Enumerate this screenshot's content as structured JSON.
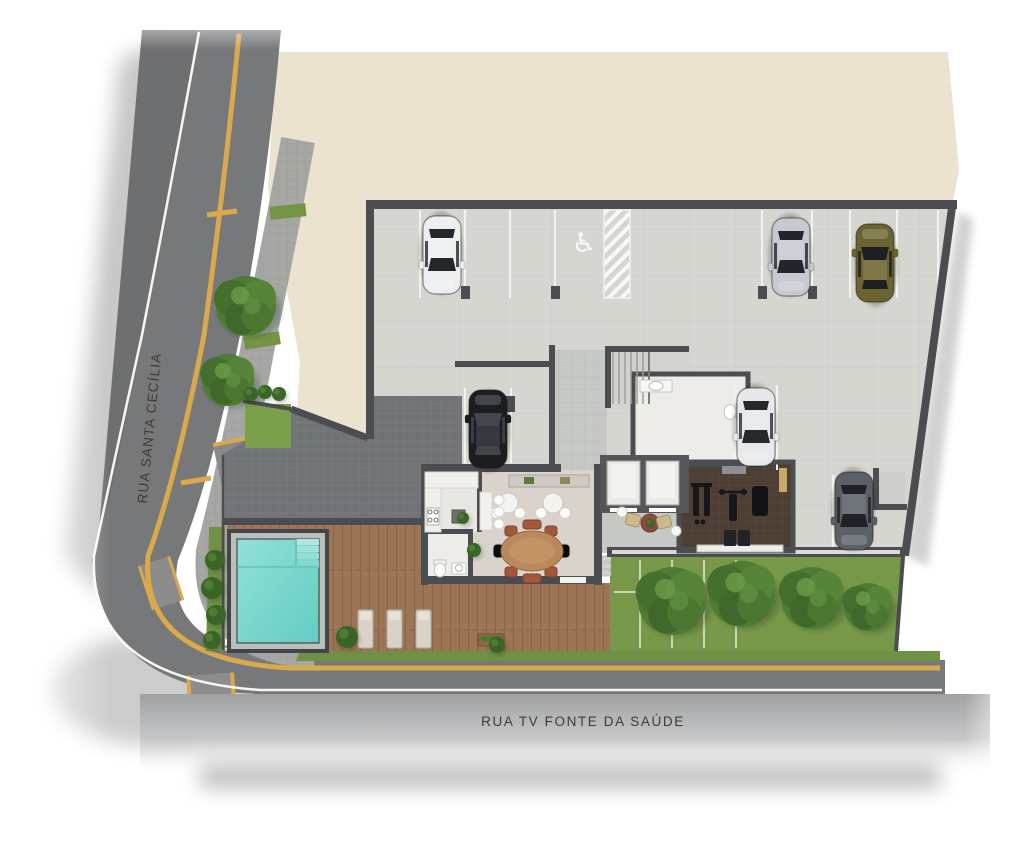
{
  "plan": {
    "kind": "architectural ground-floor site plan",
    "streets": {
      "left_label": "RUA SANTA CECÍLIA",
      "bottom_label": "RUA TV FONTE DA SAÚDE"
    },
    "accessible_symbol": "♿"
  },
  "palette": {
    "paper": "#ffffff",
    "neighbor_block": "#ebe2d0",
    "asphalt": "#77787a",
    "asphalt_far": "#6e6f70",
    "sidewalk": "#a6a7a4",
    "lane_yellow": "#d9a94b",
    "edge_white": "#fdfdfb",
    "wall": "#4b4d51",
    "garage_floor": "#d6d6d1",
    "corridor_floor": "#c6c8c5",
    "court_pavers": "#717376",
    "party_room_floor": "#d9d3cc",
    "kitchen_floor": "#e9e7e2",
    "bath_floor": "#edece8",
    "gym_floor": "#4e3f35",
    "deck_wood": "#9c7456",
    "pool_water": "#7bd5cb",
    "pool_coping": "#bcbfb9",
    "grass": "#789849",
    "tree_green": "#4f7c34"
  },
  "garage": {
    "cars": [
      {
        "name": "car-white-top",
        "x": 442,
        "y": 255,
        "rot": 180,
        "color": "#eceef0",
        "glass": "#23262b"
      },
      {
        "name": "car-silver-top",
        "x": 791,
        "y": 257,
        "rot": 180,
        "color": "#c6cad0",
        "glass": "#22252a"
      },
      {
        "name": "car-olive-top",
        "x": 875,
        "y": 263,
        "rot": 0,
        "color": "#6b6330",
        "glass": "#1d1f22"
      },
      {
        "name": "car-black-middle",
        "x": 488,
        "y": 429,
        "rot": 0,
        "color": "#1b1d21",
        "glass": "#41464d"
      },
      {
        "name": "car-white-middle",
        "x": 756,
        "y": 427,
        "rot": 180,
        "color": "#e6e8ea",
        "glass": "#25282d"
      },
      {
        "name": "car-gray-bottom",
        "x": 854,
        "y": 511,
        "rot": 180,
        "color": "#5b6066",
        "glass": "#1f2227"
      }
    ]
  },
  "vegetation": {
    "trees": [
      {
        "x": 246,
        "y": 306,
        "r": 30
      },
      {
        "x": 228,
        "y": 380,
        "r": 26
      },
      {
        "x": 672,
        "y": 601,
        "r": 34
      },
      {
        "x": 742,
        "y": 594,
        "r": 33
      },
      {
        "x": 812,
        "y": 598,
        "r": 31
      },
      {
        "x": 868,
        "y": 607,
        "r": 24
      }
    ],
    "bushes": [
      {
        "x": 251,
        "y": 394,
        "r": 7
      },
      {
        "x": 265,
        "y": 392,
        "r": 7
      },
      {
        "x": 279,
        "y": 394,
        "r": 7
      },
      {
        "x": 215,
        "y": 560,
        "r": 10
      },
      {
        "x": 212,
        "y": 588,
        "r": 11
      },
      {
        "x": 216,
        "y": 615,
        "r": 10
      },
      {
        "x": 212,
        "y": 640,
        "r": 9
      },
      {
        "x": 347,
        "y": 637,
        "r": 11
      },
      {
        "x": 497,
        "y": 645,
        "r": 8
      },
      {
        "x": 474,
        "y": 550,
        "r": 7
      },
      {
        "x": 463,
        "y": 518,
        "r": 6
      },
      {
        "x": 650,
        "y": 523,
        "r": 4
      }
    ]
  },
  "depicted_features": [
    "covered parking garage",
    "accessible parking space",
    "hatched no-parking strip",
    "stairs",
    "restroom",
    "two elevators",
    "lobby lounge",
    "gym",
    "party room with oval table",
    "kitchen",
    "deck restroom",
    "wood deck",
    "swimming pool with steps",
    "three lounge chairs",
    "rear garden with trees",
    "street trees",
    "entry court pavers",
    "lawn"
  ]
}
